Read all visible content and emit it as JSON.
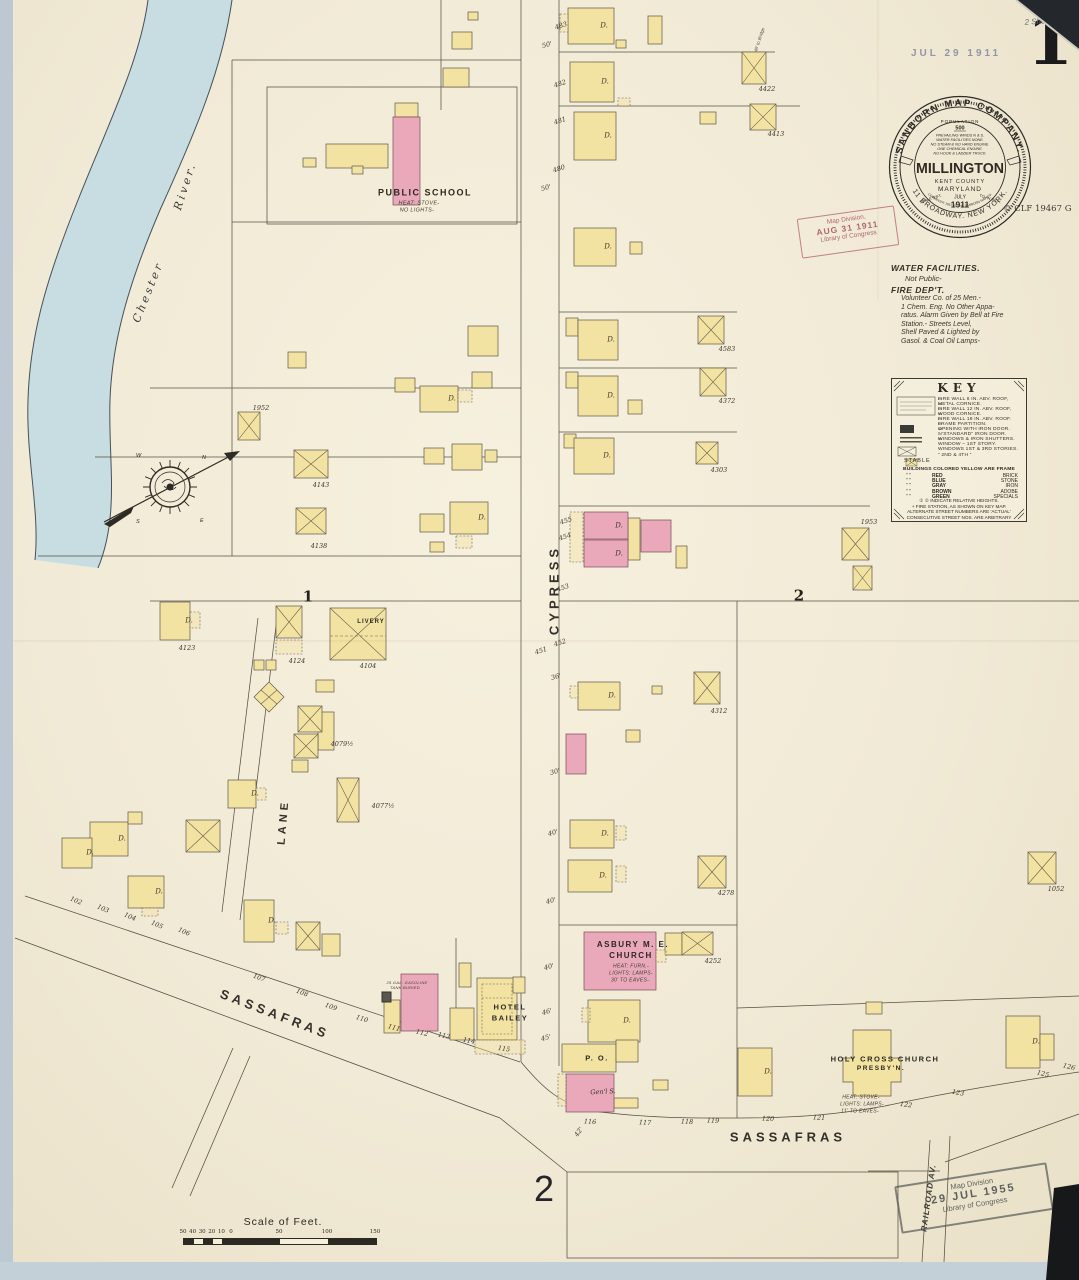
{
  "page": {
    "sheet_number": "1",
    "bottom_sheet_number": "2",
    "date_stamp": "JUL 29 1911",
    "note_line1": "1137",
    "note_line2": "2 Sheets.",
    "catalog_mark": "© CLF 19467 G"
  },
  "seal": {
    "arc_top": "SANBORN MAP COMPANY.",
    "arc_bottom": "11 BROADWAY. NEW YORK.",
    "arc_copyright": "COPYRIGHT 1911 BY THE SANBORN MAP CO.",
    "population_label": "POPULATION",
    "population_value": "500",
    "facts": [
      "PREVAILING WINDS N & S.",
      "WATER FACILITIES NONE.",
      "NO STEAM & NO HAND ENGINE.",
      "ONE CHEMICAL ENGINE.",
      "NO HOOK & LADDER TRUCK."
    ],
    "city": "MILLINGTON",
    "county": "KENT COUNTY",
    "state": "MARYLAND",
    "month": "JULY",
    "year": "1911",
    "scale_left": "SCALE 50FT.",
    "scale_right": "TO AN INCH."
  },
  "stamps": {
    "red": [
      "Map Division,",
      "AUG 31 1911",
      "Library of Congress"
    ],
    "black": [
      "Map Division",
      "29 JUL 1955",
      "Library of Congress"
    ]
  },
  "notes": {
    "water_title": "WATER FACILITIES.",
    "water_body": "Not Public-",
    "fire_title": "FIRE DEP'T.",
    "fire_body": [
      "Volunteer Co. of 25 Men.-",
      "1 Chem. Eng. No Other Appa-",
      "ratus. Alarm Given by Bell at Fire",
      "Station.- Streets Level,",
      "Shell Paved & Lighted by",
      "Gasol. & Coal Oil Lamps-"
    ]
  },
  "key": {
    "title": "KEY",
    "right_lines": [
      "FIRE WALL 6 IN. ABV. ROOF,",
      "METAL CORNICE.",
      "FIRE WALL 12 IN. ABV. ROOF,",
      "WOOD CORNICE.",
      "FIRE WALL 18 IN. ABV. ROOF.",
      "FRAME PARTITION.",
      "OPENING WITH IRON DOOR.",
      "”  “STANDARD” IRON DOOR.",
      "WINDOWS & IRON SHUTTERS.",
      "WINDOW – 1ST STORY.",
      "WINDOWS 1ST & 3RD STORIES.",
      "”   2ND & 4TH   ”"
    ],
    "stable_label": "STABLE",
    "color_intro": "BUILDINGS COLORED YELLOW ARE FRAME",
    "color_rows": [
      {
        "d": "”      ”",
        "color": "RED",
        "mat": "BRICK"
      },
      {
        "d": "”      ”",
        "color": "BLUE",
        "mat": "STONE"
      },
      {
        "d": "”      ”",
        "color": "GRAY",
        "mat": "IRON"
      },
      {
        "d": "”      ”",
        "color": "BROWN",
        "mat": "ADOBE"
      },
      {
        "d": "”      ”",
        "color": "GREEN",
        "mat": "SPECIALS"
      }
    ],
    "footnotes": [
      "① ② INDICATE RELATIVE HEIGHTS.",
      "+  FIRE STATION, AS SHOWN ON KEY MAP.",
      "ALTERNATE STREET NUMBERS ARE 'ACTUAL'",
      "CONSECUTIVE STREET NOS. ARE ARBITRARY"
    ]
  },
  "scale_bar": {
    "title": "Scale of Feet.",
    "ticks": [
      "50",
      "40",
      "30",
      "20",
      "10",
      "0",
      "50",
      "100",
      "150"
    ]
  },
  "colors": {
    "frame_yellow": "#f3e3a2",
    "brick_pink": "#e9a9bb",
    "river_blue": "#c3dbe2",
    "paper": "#f1ead6",
    "ink": "#2f2a22",
    "stamp_red": "#a85a68"
  },
  "map_labels": [
    {
      "t": "CYPRESS",
      "x": 541,
      "y": 590,
      "r": -90,
      "s": 13,
      "c": "street"
    },
    {
      "t": "LANE",
      "x": 271,
      "y": 822,
      "r": -85,
      "s": 11,
      "c": "street"
    },
    {
      "t": "SASSAFRAS",
      "x": 262,
      "y": 1014,
      "r": 21,
      "s": 13,
      "c": "street"
    },
    {
      "t": "SASSAFRAS",
      "x": 775,
      "y": 1137,
      "r": 0,
      "s": 13,
      "c": "street"
    },
    {
      "t": "RAILROAD AV.",
      "x": 916,
      "y": 1198,
      "r": -82,
      "s": 8,
      "c": "street2"
    },
    {
      "t": "Chester",
      "x": 135,
      "y": 292,
      "r": -68,
      "s": 11,
      "c": "river"
    },
    {
      "t": "River.",
      "x": 172,
      "y": 186,
      "r": -72,
      "s": 11,
      "c": "river"
    },
    {
      "t": "1",
      "x": 295,
      "y": 597,
      "r": 0,
      "s": 15,
      "c": "blocknum"
    },
    {
      "t": "2",
      "x": 786,
      "y": 596,
      "r": 0,
      "s": 15,
      "c": "blocknum"
    },
    {
      "t": "2",
      "x": 531,
      "y": 1189,
      "r": 0,
      "s": 36,
      "c": "sheet2"
    },
    {
      "t": "PUBLIC SCHOOL",
      "x": 412,
      "y": 193,
      "r": 0,
      "s": 9,
      "c": "bname"
    },
    {
      "t": "HEAT: STOVE-",
      "x": 406,
      "y": 204,
      "r": 0,
      "s": 5.5,
      "c": "bnote"
    },
    {
      "t": "NO LIGHTS-",
      "x": 404,
      "y": 211,
      "r": 0,
      "s": 5.5,
      "c": "bnote"
    },
    {
      "t": "LIVERY",
      "x": 358,
      "y": 622,
      "r": 0,
      "s": 6,
      "c": "bnamesm"
    },
    {
      "t": "ASBURY M. E.",
      "x": 620,
      "y": 945,
      "r": 0,
      "s": 8,
      "c": "bname"
    },
    {
      "t": "CHURCH",
      "x": 618,
      "y": 956,
      "r": 0,
      "s": 8,
      "c": "bname"
    },
    {
      "t": "HEAT: FURN.-",
      "x": 618,
      "y": 967,
      "r": 0,
      "s": 5,
      "c": "bnote"
    },
    {
      "t": "LIGHTS: LAMPS-",
      "x": 618,
      "y": 974,
      "r": 0,
      "s": 5,
      "c": "bnote"
    },
    {
      "t": "30' TO EAVES-",
      "x": 617,
      "y": 981,
      "r": 0,
      "s": 5,
      "c": "bnote"
    },
    {
      "t": "HOTEL",
      "x": 497,
      "y": 1007,
      "r": 0,
      "s": 7.5,
      "c": "bname"
    },
    {
      "t": "BAILEY",
      "x": 497,
      "y": 1018,
      "r": 0,
      "s": 7.5,
      "c": "bname"
    },
    {
      "t": "P. O.",
      "x": 584,
      "y": 1058,
      "r": 0,
      "s": 7.5,
      "c": "bname"
    },
    {
      "t": "Gen'l S.",
      "x": 590,
      "y": 1092,
      "r": -3,
      "s": 6.5,
      "c": "dlbl"
    },
    {
      "t": "HOLY CROSS CHURCH",
      "x": 872,
      "y": 1059,
      "r": 0,
      "s": 7.5,
      "c": "bname"
    },
    {
      "t": "PRESBY'N.",
      "x": 868,
      "y": 1069,
      "r": 0,
      "s": 6.5,
      "c": "bname"
    },
    {
      "t": "HEAT: STOVE-",
      "x": 848,
      "y": 1098,
      "r": 0,
      "s": 5,
      "c": "bnote"
    },
    {
      "t": "LIGHTS: LAMPS-",
      "x": 849,
      "y": 1105,
      "r": 0,
      "s": 5,
      "c": "bnote"
    },
    {
      "t": "11' TO EAVES-",
      "x": 847,
      "y": 1112,
      "r": 0,
      "s": 5,
      "c": "bnote"
    },
    {
      "t": "25 GAL. GASOLINE",
      "x": 394,
      "y": 983,
      "r": 0,
      "s": 4,
      "c": "bnote"
    },
    {
      "t": "TANK BURIED",
      "x": 392,
      "y": 988,
      "r": 0,
      "s": 4,
      "c": "bnote"
    },
    {
      "t": "48' to Bridge",
      "x": 747,
      "y": 40,
      "r": -72,
      "s": 4.5,
      "c": "hand"
    },
    {
      "t": "4422",
      "x": 754,
      "y": 89,
      "r": 0,
      "s": 6.5,
      "c": "num"
    },
    {
      "t": "4413",
      "x": 763,
      "y": 134,
      "r": 0,
      "s": 6.5,
      "c": "num"
    },
    {
      "t": "4583",
      "x": 714,
      "y": 349,
      "r": 0,
      "s": 6.5,
      "c": "num"
    },
    {
      "t": "4372",
      "x": 714,
      "y": 401,
      "r": 0,
      "s": 6.5,
      "c": "num"
    },
    {
      "t": "4303",
      "x": 706,
      "y": 470,
      "r": 0,
      "s": 6.5,
      "c": "num"
    },
    {
      "t": "1953",
      "x": 856,
      "y": 522,
      "r": 0,
      "s": 6.5,
      "c": "num"
    },
    {
      "t": "4312",
      "x": 706,
      "y": 711,
      "r": 0,
      "s": 6.5,
      "c": "num"
    },
    {
      "t": "4278",
      "x": 713,
      "y": 893,
      "r": 0,
      "s": 6.5,
      "c": "num"
    },
    {
      "t": "1052",
      "x": 1043,
      "y": 889,
      "r": 0,
      "s": 6.5,
      "c": "num"
    },
    {
      "t": "4252",
      "x": 700,
      "y": 961,
      "r": 0,
      "s": 6.5,
      "c": "num"
    },
    {
      "t": "4123",
      "x": 174,
      "y": 648,
      "r": 0,
      "s": 6.5,
      "c": "num"
    },
    {
      "t": "4124",
      "x": 284,
      "y": 661,
      "r": 0,
      "s": 6.5,
      "c": "num"
    },
    {
      "t": "4104",
      "x": 355,
      "y": 666,
      "r": 0,
      "s": 6.5,
      "c": "num"
    },
    {
      "t": "4079½",
      "x": 329,
      "y": 744,
      "r": 0,
      "s": 6.5,
      "c": "num"
    },
    {
      "t": "4077½",
      "x": 370,
      "y": 806,
      "r": 0,
      "s": 6.5,
      "c": "num"
    },
    {
      "t": "1952",
      "x": 248,
      "y": 408,
      "r": 0,
      "s": 6.5,
      "c": "num"
    },
    {
      "t": "4143",
      "x": 308,
      "y": 485,
      "r": 0,
      "s": 6.5,
      "c": "num"
    },
    {
      "t": "4138",
      "x": 306,
      "y": 546,
      "r": 0,
      "s": 6.5,
      "c": "num"
    },
    {
      "t": "102",
      "x": 63,
      "y": 901,
      "r": 22,
      "s": 6.5,
      "c": "snum"
    },
    {
      "t": "103",
      "x": 90,
      "y": 909,
      "r": 22,
      "s": 6.5,
      "c": "snum"
    },
    {
      "t": "104",
      "x": 117,
      "y": 917,
      "r": 22,
      "s": 6.5,
      "c": "snum"
    },
    {
      "t": "105",
      "x": 144,
      "y": 925,
      "r": 22,
      "s": 6.5,
      "c": "snum"
    },
    {
      "t": "106",
      "x": 171,
      "y": 932,
      "r": 22,
      "s": 6.5,
      "c": "snum"
    },
    {
      "t": "107",
      "x": 246,
      "y": 978,
      "r": 20,
      "s": 6.5,
      "c": "snum"
    },
    {
      "t": "108",
      "x": 289,
      "y": 993,
      "r": 20,
      "s": 6.5,
      "c": "snum"
    },
    {
      "t": "109",
      "x": 318,
      "y": 1007,
      "r": 19,
      "s": 6.5,
      "c": "snum"
    },
    {
      "t": "110",
      "x": 349,
      "y": 1019,
      "r": 18,
      "s": 6.5,
      "c": "snum"
    },
    {
      "t": "111",
      "x": 381,
      "y": 1028,
      "r": 16,
      "s": 6.5,
      "c": "snum"
    },
    {
      "t": "112",
      "x": 409,
      "y": 1033,
      "r": 14,
      "s": 6.5,
      "c": "snum"
    },
    {
      "t": "113",
      "x": 431,
      "y": 1036,
      "r": 12,
      "s": 6.5,
      "c": "snum"
    },
    {
      "t": "114",
      "x": 456,
      "y": 1041,
      "r": 10,
      "s": 6.5,
      "c": "snum"
    },
    {
      "t": "115",
      "x": 491,
      "y": 1049,
      "r": 8,
      "s": 6.5,
      "c": "snum"
    },
    {
      "t": "116",
      "x": 577,
      "y": 1122,
      "r": 3,
      "s": 6.5,
      "c": "snum"
    },
    {
      "t": "117",
      "x": 632,
      "y": 1123,
      "r": 3,
      "s": 6.5,
      "c": "snum"
    },
    {
      "t": "118",
      "x": 674,
      "y": 1122,
      "r": 2,
      "s": 6.5,
      "c": "snum"
    },
    {
      "t": "119",
      "x": 700,
      "y": 1121,
      "r": 2,
      "s": 6.5,
      "c": "snum"
    },
    {
      "t": "120",
      "x": 755,
      "y": 1119,
      "r": 2,
      "s": 6.5,
      "c": "snum"
    },
    {
      "t": "121",
      "x": 806,
      "y": 1118,
      "r": 3,
      "s": 6.5,
      "c": "snum"
    },
    {
      "t": "122",
      "x": 893,
      "y": 1105,
      "r": 8,
      "s": 6.5,
      "c": "snum"
    },
    {
      "t": "123",
      "x": 945,
      "y": 1093,
      "r": 10,
      "s": 6.5,
      "c": "snum"
    },
    {
      "t": "125",
      "x": 1030,
      "y": 1074,
      "r": 14,
      "s": 6.5,
      "c": "snum"
    },
    {
      "t": "126",
      "x": 1056,
      "y": 1067,
      "r": 14,
      "s": 6.5,
      "c": "snum"
    },
    {
      "t": "483",
      "x": 548,
      "y": 26,
      "r": -18,
      "s": 6.5,
      "c": "num"
    },
    {
      "t": "482",
      "x": 547,
      "y": 84,
      "r": -18,
      "s": 6.5,
      "c": "num"
    },
    {
      "t": "481",
      "x": 547,
      "y": 121,
      "r": -18,
      "s": 6.5,
      "c": "num"
    },
    {
      "t": "480",
      "x": 546,
      "y": 169,
      "r": -18,
      "s": 6.5,
      "c": "num"
    },
    {
      "t": "455",
      "x": 553,
      "y": 521,
      "r": -18,
      "s": 6.5,
      "c": "num"
    },
    {
      "t": "454",
      "x": 552,
      "y": 537,
      "r": -18,
      "s": 6.5,
      "c": "num"
    },
    {
      "t": "453",
      "x": 550,
      "y": 588,
      "r": -18,
      "s": 6.5,
      "c": "num"
    },
    {
      "t": "452",
      "x": 547,
      "y": 643,
      "r": -18,
      "s": 6.5,
      "c": "num"
    },
    {
      "t": "451",
      "x": 528,
      "y": 651,
      "r": -18,
      "s": 6.5,
      "c": "num"
    },
    {
      "t": "50'",
      "x": 534,
      "y": 45,
      "r": -15,
      "s": 6.5,
      "c": "dim"
    },
    {
      "t": "50'",
      "x": 533,
      "y": 188,
      "r": -15,
      "s": 6.5,
      "c": "dim"
    },
    {
      "t": "36'",
      "x": 543,
      "y": 677,
      "r": -15,
      "s": 6.5,
      "c": "dim"
    },
    {
      "t": "30'",
      "x": 542,
      "y": 772,
      "r": -15,
      "s": 6.5,
      "c": "dim"
    },
    {
      "t": "40'",
      "x": 540,
      "y": 833,
      "r": -15,
      "s": 6.5,
      "c": "dim"
    },
    {
      "t": "40'",
      "x": 538,
      "y": 901,
      "r": -15,
      "s": 6.5,
      "c": "dim"
    },
    {
      "t": "40'",
      "x": 536,
      "y": 967,
      "r": -15,
      "s": 6.5,
      "c": "dim"
    },
    {
      "t": "46'",
      "x": 534,
      "y": 1012,
      "r": -15,
      "s": 6.5,
      "c": "dim"
    },
    {
      "t": "45'",
      "x": 533,
      "y": 1038,
      "r": -15,
      "s": 6.5,
      "c": "dim"
    },
    {
      "t": "42'",
      "x": 566,
      "y": 1132,
      "r": -55,
      "s": 6.5,
      "c": "dim"
    },
    {
      "t": "D.",
      "x": 591,
      "y": 26,
      "r": 0,
      "s": 7,
      "c": "dlbl"
    },
    {
      "t": "D.",
      "x": 592,
      "y": 82,
      "r": 0,
      "s": 7,
      "c": "dlbl"
    },
    {
      "t": "D.",
      "x": 595,
      "y": 136,
      "r": 0,
      "s": 7,
      "c": "dlbl"
    },
    {
      "t": "D.",
      "x": 595,
      "y": 247,
      "r": 0,
      "s": 7,
      "c": "dlbl"
    },
    {
      "t": "D.",
      "x": 598,
      "y": 340,
      "r": 0,
      "s": 7,
      "c": "dlbl"
    },
    {
      "t": "D.",
      "x": 598,
      "y": 396,
      "r": 0,
      "s": 7,
      "c": "dlbl"
    },
    {
      "t": "D.",
      "x": 594,
      "y": 456,
      "r": 0,
      "s": 7,
      "c": "dlbl"
    },
    {
      "t": "D.",
      "x": 606,
      "y": 526,
      "r": 0,
      "s": 7,
      "c": "dlbl"
    },
    {
      "t": "D.",
      "x": 606,
      "y": 554,
      "r": 0,
      "s": 7,
      "c": "dlbl"
    },
    {
      "t": "D.",
      "x": 599,
      "y": 696,
      "r": 0,
      "s": 7,
      "c": "dlbl"
    },
    {
      "t": "D.",
      "x": 592,
      "y": 834,
      "r": 0,
      "s": 7,
      "c": "dlbl"
    },
    {
      "t": "D.",
      "x": 590,
      "y": 876,
      "r": 0,
      "s": 7,
      "c": "dlbl"
    },
    {
      "t": "D.",
      "x": 614,
      "y": 1021,
      "r": 0,
      "s": 7,
      "c": "dlbl"
    },
    {
      "t": "D.",
      "x": 176,
      "y": 621,
      "r": 0,
      "s": 7,
      "c": "dlbl"
    },
    {
      "t": "D.",
      "x": 109,
      "y": 839,
      "r": 0,
      "s": 7,
      "c": "dlbl"
    },
    {
      "t": "D.",
      "x": 77,
      "y": 853,
      "r": 0,
      "s": 7,
      "c": "dlbl"
    },
    {
      "t": "D.",
      "x": 146,
      "y": 892,
      "r": 0,
      "s": 7,
      "c": "dlbl"
    },
    {
      "t": "D.",
      "x": 259,
      "y": 921,
      "r": 0,
      "s": 7,
      "c": "dlbl"
    },
    {
      "t": "D.",
      "x": 242,
      "y": 794,
      "r": 0,
      "s": 7,
      "c": "dlbl"
    },
    {
      "t": "D.",
      "x": 439,
      "y": 399,
      "r": 0,
      "s": 7,
      "c": "dlbl"
    },
    {
      "t": "D.",
      "x": 469,
      "y": 518,
      "r": 0,
      "s": 7,
      "c": "dlbl"
    },
    {
      "t": "D.",
      "x": 755,
      "y": 1072,
      "r": 0,
      "s": 7,
      "c": "dlbl"
    },
    {
      "t": "D.",
      "x": 1023,
      "y": 1042,
      "r": 0,
      "s": 7,
      "c": "dlbl"
    }
  ]
}
